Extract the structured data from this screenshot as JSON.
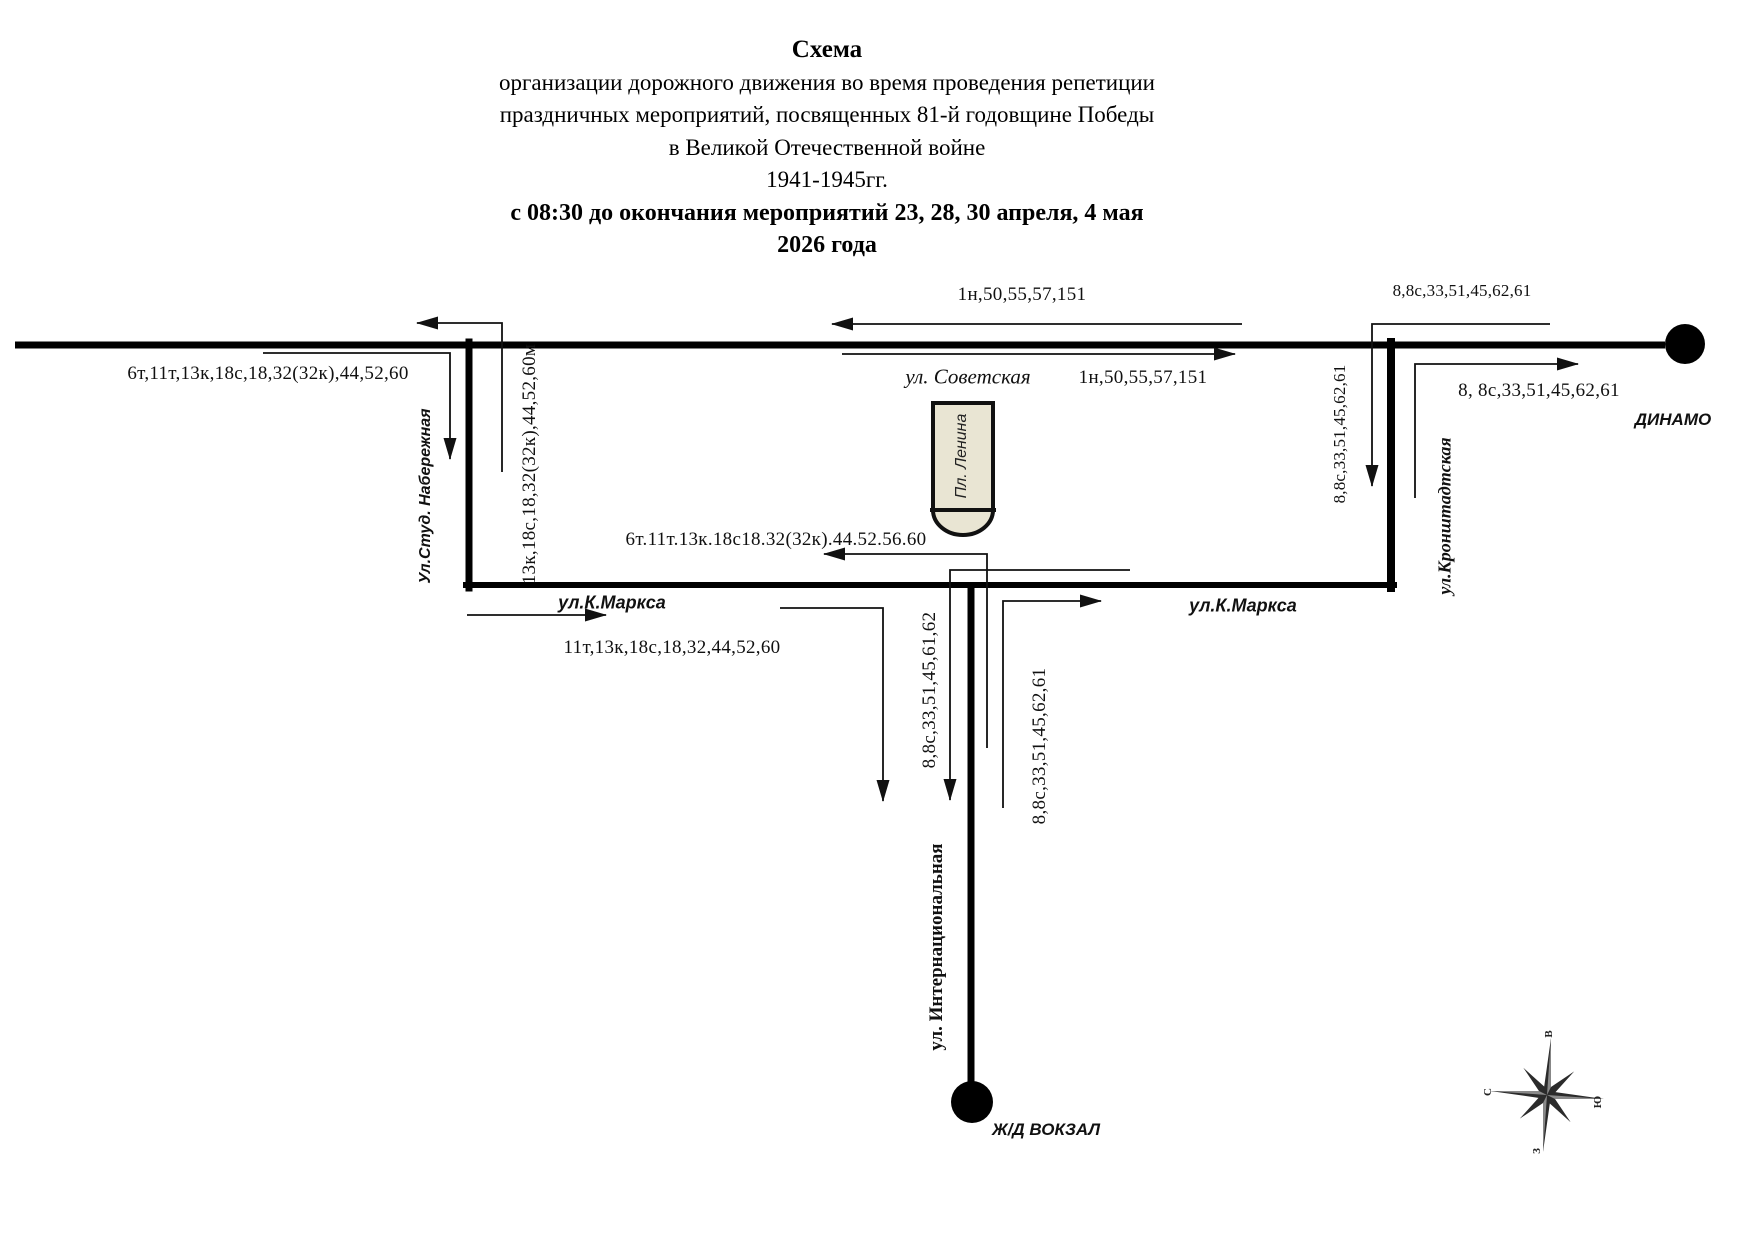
{
  "title": {
    "line1": "Схема",
    "line2": "организации дорожного движения во время проведения репетиции",
    "line3": "праздничных мероприятий, посвященных 81-й годовщине Победы",
    "line4": "в Великой Отечественной войне",
    "line5": "1941-1945гг.",
    "line6": "с 08:30 до окончания мероприятий  23, 28, 30 апреля, 4 мая",
    "line7": "2026 года"
  },
  "streets": {
    "sovetskaya": "ул. Советская",
    "k_marksa_left": "ул.К.Маркса",
    "k_marksa_right": "ул.К.Маркса",
    "stud_naberezhnaya": "Ул.Студ. Набережная",
    "kronshtadtskaya": "ул.Кронштадтская",
    "internatsionalnaya": "ул. Интернациональная",
    "pl_lenina": "Пл. Ленина"
  },
  "landmarks": {
    "dinamo": "ДИНАМО",
    "zhd_vokzal": "Ж/Д ВОКЗАЛ"
  },
  "routes": {
    "top_left": "6т,11т,13к,18с,18,32(32к),44,52,60",
    "stud_vertical": "13к,18с,18,32(32к),44,52,60м",
    "sovetskaya_west": "1н,50,55,57,151",
    "sovetskaya_east": "1н,50,55,57,151",
    "dinamo_top": "8,8с,33,51,45,62,61",
    "dinamo_exit": "8, 8с,33,51,45,62,61",
    "kron_down": "8,8с,33,51,45,62,61",
    "lenina_west": "6т.11т.13к.18с18.32(32к).44.52.56.60",
    "marksa_west": "11т,13к,18с,18,32,44,52,60",
    "intern_left": "8,8с,33,51,45,61,62",
    "intern_right": "8,8с,33,51,45,62,61"
  },
  "compass": {
    "north": "С",
    "east": "В",
    "south": "Ю",
    "west": "З"
  },
  "colors": {
    "road": "#000000",
    "thin_line": "#111111",
    "building_fill": "#e9e5d3",
    "star_dark": "#2b2b2b",
    "star_light": "#8a8a8a"
  }
}
